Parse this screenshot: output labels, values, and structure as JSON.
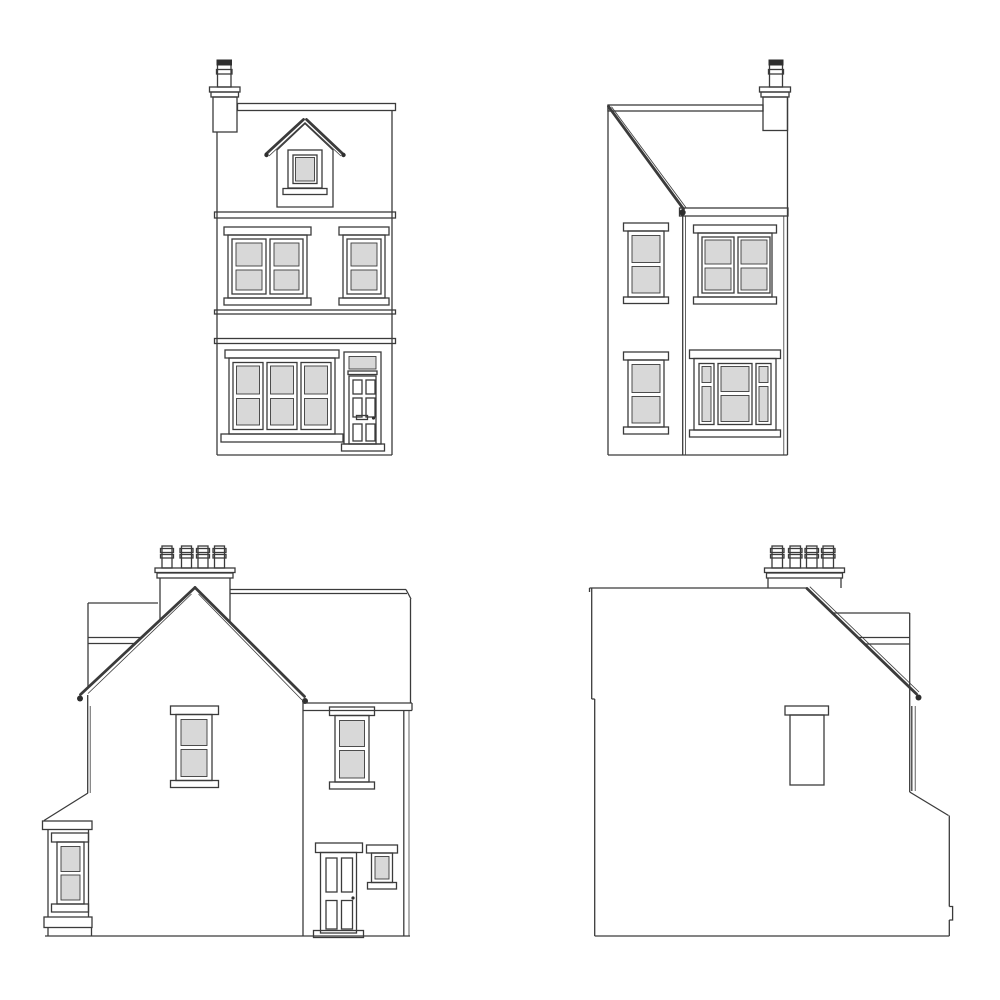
{
  "page": {
    "kind": "architectural line drawing",
    "subject": "Four elevation drawings of a Victorian-style terraced house",
    "background": "#ffffff"
  },
  "colors": {
    "line": "#3b3b3b",
    "glazing": "#d8d8d8",
    "dark": "#2e2e2e",
    "wall": "#ffffff"
  },
  "views": [
    {
      "id": "front-elevation",
      "label": "Front elevation",
      "position": "top-left",
      "features": [
        "chimney with single pot",
        "gable dormer with small window",
        "double and single sash windows on first floor",
        "fascia band between floors",
        "three-bay ground-floor window",
        "panelled front door with glazed transom"
      ]
    },
    {
      "id": "rear-elevation",
      "label": "Rear elevation",
      "position": "top-right",
      "features": [
        "catslide roof sloping to rear outrigger",
        "chimney with single pot at ridge",
        "two stacked sash windows on outrigger",
        "double sash window on first floor",
        "tripartite sash window on ground floor"
      ]
    },
    {
      "id": "left-side-elevation",
      "label": "Left side elevation",
      "position": "bottom-left",
      "features": [
        "chimney stack with four pots",
        "front-facing gable",
        "sash window in gable wall",
        "rear wing with sash window, panelled door and small window",
        "side bay with lean-to roof and sash window",
        "rainwater pipe at rear corner"
      ]
    },
    {
      "id": "right-side-elevation",
      "label": "Right side elevation",
      "position": "bottom-right",
      "features": [
        "chimney stack with four pots",
        "mostly blank flank wall",
        "single blocked window with lintel",
        "rear catslide slope with gutter and rainwater pipe"
      ]
    }
  ]
}
